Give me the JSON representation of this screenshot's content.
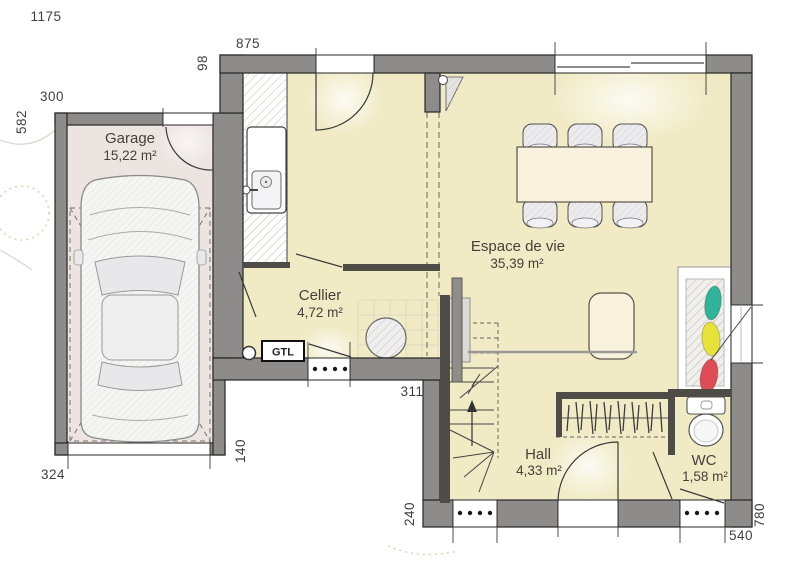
{
  "plan": {
    "rooms": {
      "garage": {
        "name": "Garage",
        "area": "15,22 m²"
      },
      "cellier": {
        "name": "Cellier",
        "area": "4,72 m²"
      },
      "espace_de_vie": {
        "name": "Espace de vie",
        "area": "35,39 m²"
      },
      "hall": {
        "name": "Hall",
        "area": "4,33 m²"
      },
      "wc": {
        "name": "WC",
        "area": "1,58 m²"
      }
    },
    "equipment": {
      "gtl": "GTL"
    },
    "dimensions": {
      "d1175": "1175",
      "d875": "875",
      "d98": "98",
      "d300": "300",
      "d582": "582",
      "d324": "324",
      "d140": "140",
      "d311": "311",
      "d240": "240",
      "d540": "540",
      "d780": "780"
    },
    "colors": {
      "floor": "#f0ebc5",
      "garage_floor": "#ece4e1",
      "wall": "#8e8c8a",
      "interior_wall": "#4f4b47",
      "accent_teal": "#2fb39b",
      "accent_yellow": "#e6e23a",
      "accent_red": "#e14b55"
    }
  }
}
